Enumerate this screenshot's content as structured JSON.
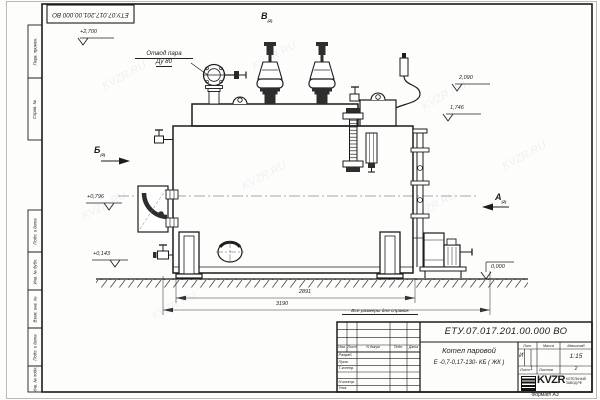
{
  "watermark": "KVZR.RU",
  "stamp": {
    "doc_number": "ЕТУ.07.017.201.00.000  ВО"
  },
  "frame": {
    "label_perv": "Перв. примен.",
    "label_sprav": "Справ. №",
    "label_podp1": "Подп. и дата",
    "label_inv_dubl": "Инв. № дубл.",
    "label_vzam": "Взам. инв. №",
    "label_podp2": "Подп. и дата",
    "label_inv_podl": "Инв. № подл.",
    "format_note": "Формат А3"
  },
  "drawing": {
    "callout_steam_line1": "Отвод пара",
    "callout_steam_line2": "Ду 80",
    "view_b": "Б",
    "view_v": "В",
    "view_a": "А",
    "view_sheet_ref": "(2)",
    "elev_top": "+2,700",
    "elev_burner": "+0,796",
    "elev_low": "+0,143",
    "elev_right_top": "2,090",
    "elev_right_mid": "1,746",
    "elev_ground": "0,000",
    "dim_inner": "2891",
    "dim_outer": "3190",
    "note": "Все размеры для справок"
  },
  "title_block": {
    "doc_number": "ЕТУ.07.017.201.00.000  ВО",
    "name_line1": "Котел паровой",
    "name_line2": "Е -0,7-0,17-130- КБ ( ЖК )",
    "col_izm": "Изм.",
    "col_list": "Лист",
    "col_doc": "N докум.",
    "col_podp": "Подп.",
    "col_data": "Дата",
    "row_razrab": "Разраб.",
    "row_prov": "Пров.",
    "row_tkontr": "Т.контр.",
    "row_nkontr": "Н.контр.",
    "row_utv": "Утв.",
    "lit_header": "Лит.",
    "mass_header": "Масса",
    "scale_header": "Масштаб",
    "lit_value": "И",
    "scale_value": "1:15",
    "sheet_label": "Лист",
    "sheet_value": "1",
    "sheets_label": "Листов",
    "sheets_value": "2",
    "logo_text": "KVZR",
    "logo_cap1": "КОТЕЛЬНЫЙ",
    "logo_cap2": "ЗАВОД РФ"
  }
}
